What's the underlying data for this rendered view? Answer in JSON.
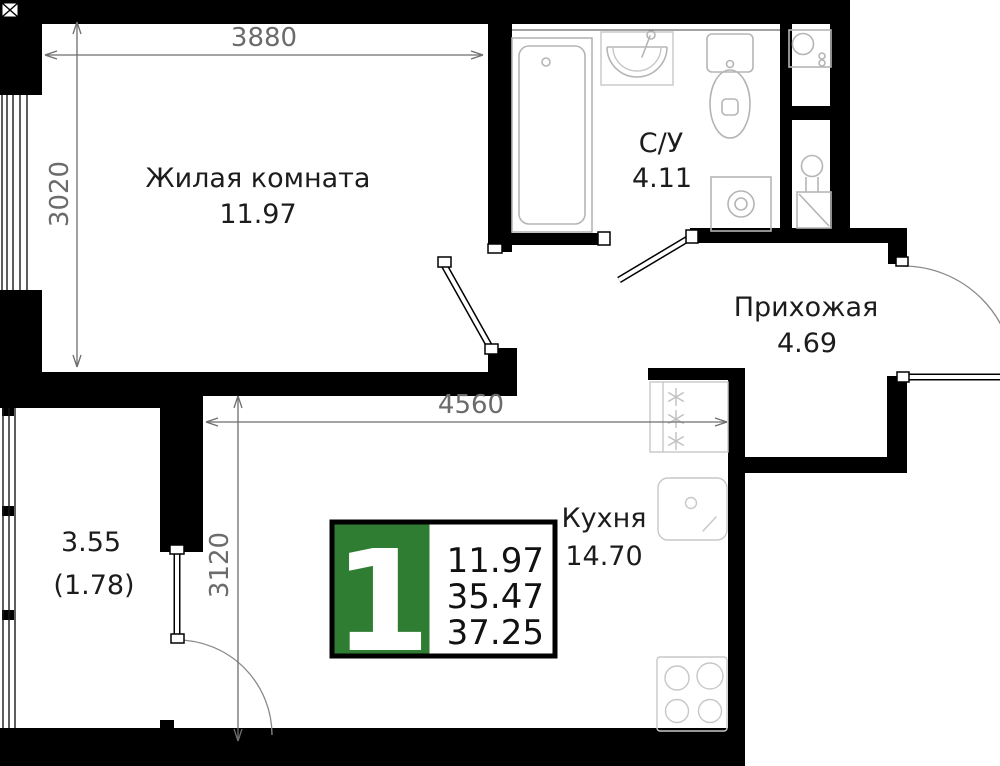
{
  "plan": {
    "rooms": {
      "living": {
        "name": "Жилая комната",
        "area": "11.97"
      },
      "bathroom": {
        "name": "С/У",
        "area": "4.11"
      },
      "hallway": {
        "name": "Прихожая",
        "area": "4.69"
      },
      "kitchen": {
        "name": "Кухня",
        "area": "14.70"
      },
      "balcony": {
        "area": "3.55",
        "area_coef": "(1.78)"
      }
    },
    "dimensions": {
      "living_width": "3880",
      "living_depth": "3020",
      "kitchen_width": "4560",
      "kitchen_depth": "3120"
    },
    "badge": {
      "room_count": "1",
      "living_area": "11.97",
      "area_no_balcony": "35.47",
      "total_area": "37.25",
      "accent_color": "#2e7d32"
    }
  }
}
